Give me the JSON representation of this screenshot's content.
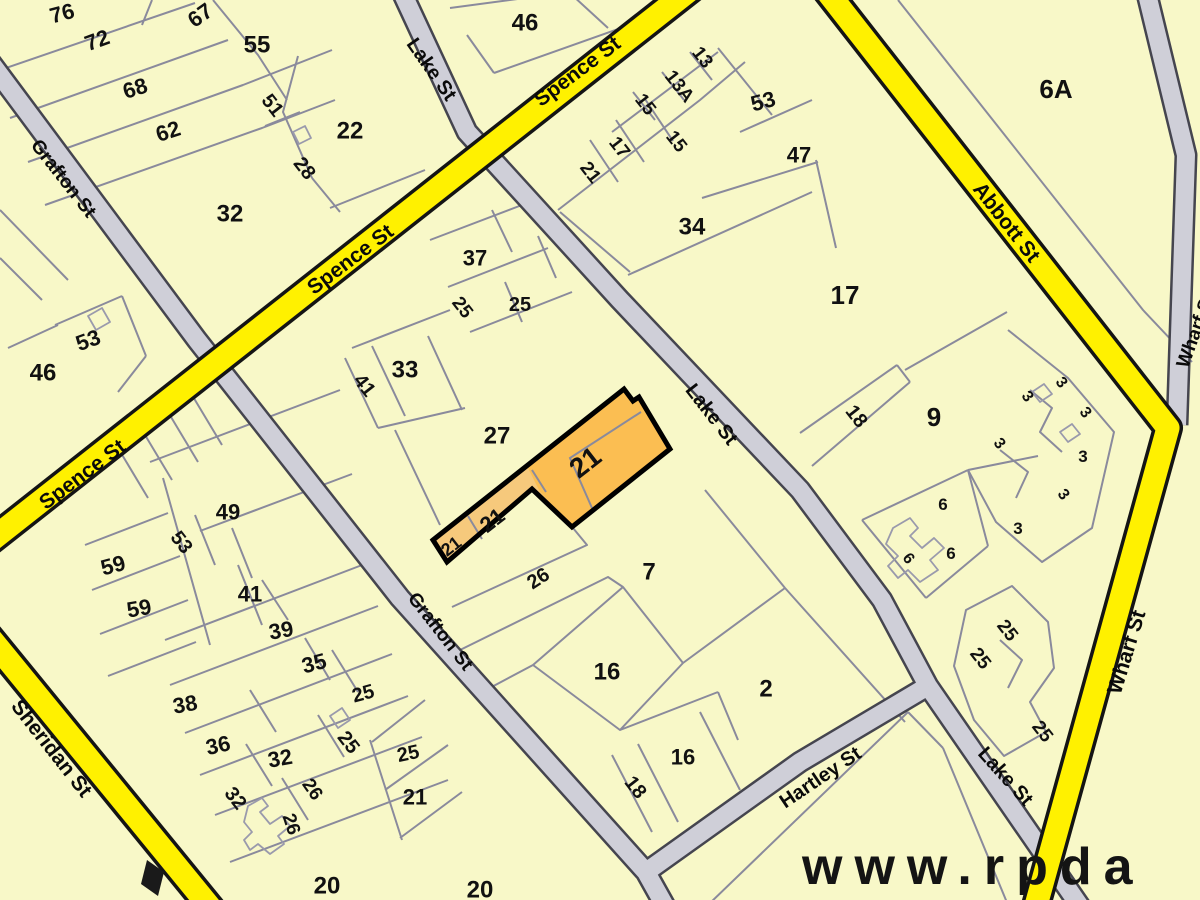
{
  "watermark": {
    "text": "www.rpda"
  },
  "colors": {
    "parcel_fill": "#F8F8C8",
    "parcel_line": "#8A8A9C",
    "building_line": "#9A9AAC",
    "major_road_fill": "#FFF100",
    "major_road_casing": "#141414",
    "minor_road_fill": "#CFCFD8",
    "minor_road_casing": "#45454F",
    "highlight_fill": "#FBBE52",
    "highlight_strip_fill": "#F6C97C",
    "highlight_outline": "#000000",
    "label_color": "#111111"
  },
  "streets": [
    "Spence St",
    "Grafton St",
    "Lake St",
    "Abbott St",
    "Wharf St",
    "Sheridan St",
    "Hartley St"
  ],
  "highlighted_parcel": {
    "lot": "21",
    "labels": [
      "21",
      "21",
      "21"
    ]
  },
  "street_labels": [
    {
      "text": "Grafton St",
      "x": 64,
      "y": 178,
      "r": 52,
      "s": 19
    },
    {
      "text": "Grafton St",
      "x": 441,
      "y": 631,
      "r": 52,
      "s": 19
    },
    {
      "text": "Spence St",
      "x": 577,
      "y": 71,
      "r": -37,
      "s": 21
    },
    {
      "text": "Spence St",
      "x": 350,
      "y": 259,
      "r": -37,
      "s": 21
    },
    {
      "text": "Spence St",
      "x": 82,
      "y": 474,
      "r": -37,
      "s": 21
    },
    {
      "text": "Lake St",
      "x": 432,
      "y": 69,
      "r": 55,
      "s": 20
    },
    {
      "text": "Lake St",
      "x": 712,
      "y": 414,
      "r": 52,
      "s": 20
    },
    {
      "text": "Lake St",
      "x": 1006,
      "y": 776,
      "r": 48,
      "s": 20
    },
    {
      "text": "Abbott St",
      "x": 1007,
      "y": 222,
      "r": 52,
      "s": 21
    },
    {
      "text": "Wharf St",
      "x": 1126,
      "y": 652,
      "r": -73,
      "s": 21
    },
    {
      "text": "Wharf St",
      "x": 1195,
      "y": 330,
      "r": -70,
      "s": 19
    },
    {
      "text": "Sheridan St",
      "x": 52,
      "y": 748,
      "r": 52,
      "s": 21
    },
    {
      "text": "Hartley St",
      "x": 820,
      "y": 777,
      "r": -34,
      "s": 20
    }
  ],
  "lot_labels": [
    {
      "text": "76",
      "x": 62,
      "y": 13,
      "r": -15,
      "s": 22
    },
    {
      "text": "72",
      "x": 97,
      "y": 40,
      "r": -20,
      "s": 22
    },
    {
      "text": "68",
      "x": 135,
      "y": 88,
      "r": -18,
      "s": 22
    },
    {
      "text": "62",
      "x": 168,
      "y": 131,
      "r": -18,
      "s": 22
    },
    {
      "text": "67",
      "x": 200,
      "y": 15,
      "r": -35,
      "s": 22
    },
    {
      "text": "55",
      "x": 257,
      "y": 44,
      "r": 0,
      "s": 24
    },
    {
      "text": "51",
      "x": 273,
      "y": 105,
      "r": 52,
      "s": 20
    },
    {
      "text": "28",
      "x": 305,
      "y": 168,
      "r": 52,
      "s": 20
    },
    {
      "text": "22",
      "x": 350,
      "y": 130,
      "r": 0,
      "s": 24
    },
    {
      "text": "32",
      "x": 230,
      "y": 213,
      "r": 0,
      "s": 24
    },
    {
      "text": "46",
      "x": 525,
      "y": 22,
      "r": 0,
      "s": 24
    },
    {
      "text": "53",
      "x": 88,
      "y": 340,
      "r": -20,
      "s": 22
    },
    {
      "text": "46",
      "x": 43,
      "y": 372,
      "r": 0,
      "s": 24
    },
    {
      "text": "13",
      "x": 703,
      "y": 57,
      "r": 52,
      "s": 19
    },
    {
      "text": "13A",
      "x": 680,
      "y": 86,
      "r": 52,
      "s": 19
    },
    {
      "text": "15",
      "x": 646,
      "y": 104,
      "r": 52,
      "s": 19
    },
    {
      "text": "15",
      "x": 677,
      "y": 141,
      "r": 52,
      "s": 19
    },
    {
      "text": "17",
      "x": 620,
      "y": 147,
      "r": 52,
      "s": 19
    },
    {
      "text": "21",
      "x": 591,
      "y": 172,
      "r": 52,
      "s": 19
    },
    {
      "text": "53",
      "x": 763,
      "y": 101,
      "r": -15,
      "s": 22
    },
    {
      "text": "47",
      "x": 799,
      "y": 155,
      "r": 0,
      "s": 22
    },
    {
      "text": "34",
      "x": 692,
      "y": 226,
      "r": 0,
      "s": 24
    },
    {
      "text": "17",
      "x": 845,
      "y": 295,
      "r": 0,
      "s": 26
    },
    {
      "text": "18",
      "x": 857,
      "y": 416,
      "r": 52,
      "s": 20
    },
    {
      "text": "9",
      "x": 934,
      "y": 417,
      "r": 0,
      "s": 26
    },
    {
      "text": "6A",
      "x": 1056,
      "y": 89,
      "r": 0,
      "s": 26
    },
    {
      "text": "3",
      "x": 1028,
      "y": 396,
      "r": 52,
      "s": 16
    },
    {
      "text": "3",
      "x": 1062,
      "y": 382,
      "r": 52,
      "s": 16
    },
    {
      "text": "3",
      "x": 1086,
      "y": 412,
      "r": 52,
      "s": 16
    },
    {
      "text": "3",
      "x": 1000,
      "y": 443,
      "r": 52,
      "s": 16
    },
    {
      "text": "3",
      "x": 1083,
      "y": 456,
      "r": 0,
      "s": 17
    },
    {
      "text": "3",
      "x": 1064,
      "y": 494,
      "r": 52,
      "s": 16
    },
    {
      "text": "3",
      "x": 1018,
      "y": 528,
      "r": 0,
      "s": 17
    },
    {
      "text": "6",
      "x": 943,
      "y": 504,
      "r": 0,
      "s": 17
    },
    {
      "text": "6",
      "x": 909,
      "y": 558,
      "r": 52,
      "s": 16
    },
    {
      "text": "6",
      "x": 951,
      "y": 553,
      "r": 0,
      "s": 17
    },
    {
      "text": "25",
      "x": 1008,
      "y": 630,
      "r": 52,
      "s": 19
    },
    {
      "text": "25",
      "x": 981,
      "y": 658,
      "r": 52,
      "s": 19
    },
    {
      "text": "25",
      "x": 1043,
      "y": 731,
      "r": 52,
      "s": 19
    },
    {
      "text": "37",
      "x": 475,
      "y": 258,
      "r": 0,
      "s": 22
    },
    {
      "text": "25",
      "x": 463,
      "y": 307,
      "r": 52,
      "s": 19
    },
    {
      "text": "25",
      "x": 520,
      "y": 304,
      "r": 0,
      "s": 20
    },
    {
      "text": "33",
      "x": 405,
      "y": 369,
      "r": 0,
      "s": 24
    },
    {
      "text": "41",
      "x": 365,
      "y": 385,
      "r": 52,
      "s": 20
    },
    {
      "text": "27",
      "x": 497,
      "y": 435,
      "r": 0,
      "s": 24
    },
    {
      "text": "26",
      "x": 538,
      "y": 578,
      "r": -33,
      "s": 20
    },
    {
      "text": "7",
      "x": 649,
      "y": 571,
      "r": 0,
      "s": 24
    },
    {
      "text": "16",
      "x": 607,
      "y": 671,
      "r": 0,
      "s": 24
    },
    {
      "text": "2",
      "x": 766,
      "y": 688,
      "r": 0,
      "s": 24
    },
    {
      "text": "16",
      "x": 683,
      "y": 757,
      "r": 0,
      "s": 22
    },
    {
      "text": "18",
      "x": 636,
      "y": 787,
      "r": 52,
      "s": 20
    },
    {
      "text": "49",
      "x": 228,
      "y": 512,
      "r": 0,
      "s": 22
    },
    {
      "text": "53",
      "x": 182,
      "y": 542,
      "r": 52,
      "s": 20
    },
    {
      "text": "59",
      "x": 113,
      "y": 565,
      "r": -15,
      "s": 22
    },
    {
      "text": "59",
      "x": 139,
      "y": 608,
      "r": -10,
      "s": 22
    },
    {
      "text": "41",
      "x": 250,
      "y": 594,
      "r": 0,
      "s": 22
    },
    {
      "text": "39",
      "x": 281,
      "y": 630,
      "r": -10,
      "s": 22
    },
    {
      "text": "38",
      "x": 185,
      "y": 704,
      "r": -10,
      "s": 22
    },
    {
      "text": "35",
      "x": 314,
      "y": 663,
      "r": -15,
      "s": 22
    },
    {
      "text": "36",
      "x": 218,
      "y": 745,
      "r": -12,
      "s": 22
    },
    {
      "text": "25",
      "x": 363,
      "y": 693,
      "r": -15,
      "s": 20
    },
    {
      "text": "25",
      "x": 349,
      "y": 742,
      "r": 52,
      "s": 20
    },
    {
      "text": "32",
      "x": 280,
      "y": 758,
      "r": -10,
      "s": 22
    },
    {
      "text": "32",
      "x": 236,
      "y": 798,
      "r": 52,
      "s": 20
    },
    {
      "text": "26",
      "x": 313,
      "y": 789,
      "r": 55,
      "s": 19
    },
    {
      "text": "26",
      "x": 292,
      "y": 824,
      "r": 72,
      "s": 19
    },
    {
      "text": "25",
      "x": 408,
      "y": 753,
      "r": -12,
      "s": 20
    },
    {
      "text": "21",
      "x": 415,
      "y": 797,
      "r": 0,
      "s": 22
    },
    {
      "text": "20",
      "x": 327,
      "y": 885,
      "r": 0,
      "s": 24
    },
    {
      "text": "20",
      "x": 480,
      "y": 889,
      "r": 0,
      "s": 24
    }
  ],
  "highlight_labels": [
    {
      "text": "21",
      "x": 585,
      "y": 462,
      "r": -38,
      "s": 28
    },
    {
      "text": "21",
      "x": 492,
      "y": 520,
      "r": -38,
      "s": 22
    },
    {
      "text": "21",
      "x": 451,
      "y": 546,
      "r": -38,
      "s": 18
    }
  ]
}
